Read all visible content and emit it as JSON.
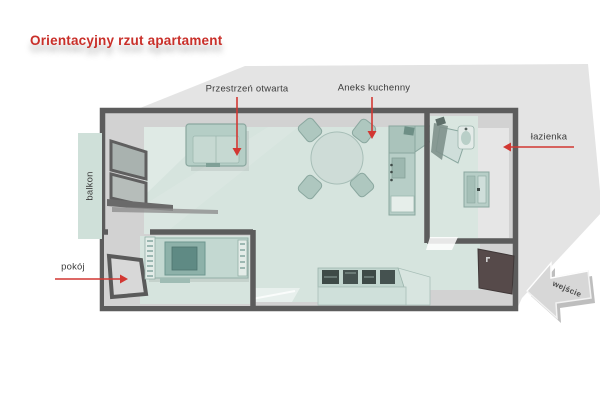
{
  "title": "Orientacyjny rzut apartament",
  "plan": {
    "labels": {
      "open_space": "Przestrzeń otwarta",
      "kitchenette": "Aneks kuchenny",
      "bathroom": "łazienka",
      "balcony": "balkon",
      "bedroom": "pokój",
      "entrance": "wejście"
    }
  },
  "colors": {
    "accent_red": "#d23732",
    "title_red": "#c92f29",
    "backdrop_gray": "#e4e4e4",
    "interior_gray": "#d2d2d2",
    "wall_gray": "#5c5c5c",
    "floor_teal": "#d6e4de",
    "furniture_teal": "#b5cec6",
    "entry_door_brown": "#564a4a",
    "label_text": "#3b3b3b"
  }
}
